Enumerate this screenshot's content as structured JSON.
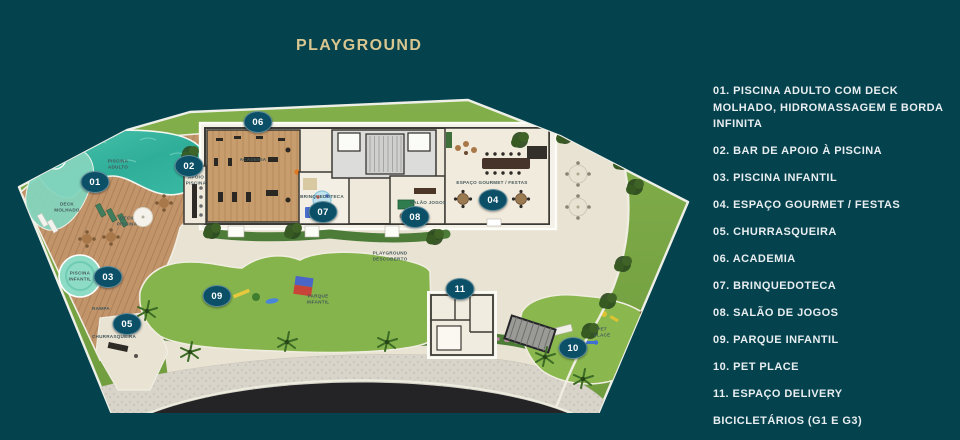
{
  "title": {
    "text": "PLAYGROUND"
  },
  "colors": {
    "background": "#04424e",
    "title": "#d8c690",
    "badge": "#0c5068",
    "legendtext": "#e8eef0",
    "labelink": "#44585a",
    "grass": "#7ca946",
    "patio": "#e9e3d3",
    "pool": "#35b3a0",
    "deck": "#c2946a"
  },
  "legend": {
    "items": [
      {
        "number": "01.",
        "text": "PISCINA ADULTO COM DECK MOLHADO, HIDROMASSAGEM E BORDA INFINITA"
      },
      {
        "number": "02.",
        "text": "BAR DE APOIO À PISCINA"
      },
      {
        "number": "03.",
        "text": "PISCINA INFANTIL"
      },
      {
        "number": "04.",
        "text": "ESPAÇO GOURMET / FESTAS"
      },
      {
        "number": "05.",
        "text": "CHURRASQUEIRA"
      },
      {
        "number": "06.",
        "text": "ACADEMIA"
      },
      {
        "number": "07.",
        "text": "BRINQUEDOTECA"
      },
      {
        "number": "08.",
        "text": "SALÃO DE JOGOS"
      },
      {
        "number": "09.",
        "text": "PARQUE INFANTIL"
      },
      {
        "number": "10.",
        "text": "PET PLACE"
      },
      {
        "number": "11.",
        "text": "ESPAÇO DELIVERY"
      },
      {
        "number": "",
        "text": "BICICLETÁRIOS (G1 E G3)"
      }
    ]
  },
  "plan": {
    "markers": [
      {
        "id": "01",
        "x": 95,
        "y": 182
      },
      {
        "id": "02",
        "x": 189,
        "y": 166
      },
      {
        "id": "03",
        "x": 108,
        "y": 277
      },
      {
        "id": "04",
        "x": 493,
        "y": 200
      },
      {
        "id": "05",
        "x": 127,
        "y": 324
      },
      {
        "id": "06",
        "x": 258,
        "y": 122
      },
      {
        "id": "07",
        "x": 323,
        "y": 212
      },
      {
        "id": "08",
        "x": 415,
        "y": 217
      },
      {
        "id": "09",
        "x": 217,
        "y": 296
      },
      {
        "id": "10",
        "x": 573,
        "y": 348
      },
      {
        "id": "11",
        "x": 460,
        "y": 289
      }
    ],
    "labels": [
      {
        "text": "PISCINA\nADULTO",
        "x": 118,
        "y": 164
      },
      {
        "text": "DECK\nMOLHADO",
        "x": 67,
        "y": 207
      },
      {
        "text": "DECK\nPISCINA",
        "x": 127,
        "y": 221
      },
      {
        "text": "PISCINA\nINFANTIL",
        "x": 80,
        "y": 276
      },
      {
        "text": "RAMPA",
        "x": 101,
        "y": 309
      },
      {
        "text": "CHURRASQUEIRA",
        "x": 114,
        "y": 337
      },
      {
        "text": "APOIO\nPISCINA",
        "x": 196,
        "y": 180
      },
      {
        "text": "ACADEMIA",
        "x": 253,
        "y": 160
      },
      {
        "text": "BRINQUEDOTECA",
        "x": 322,
        "y": 197
      },
      {
        "text": "SALÃO JOGOS",
        "x": 428,
        "y": 203
      },
      {
        "text": "ESPAÇO GOURMET / FESTAS",
        "x": 492,
        "y": 183
      },
      {
        "text": "PLAYGROUND\nDESCOBERTO",
        "x": 390,
        "y": 256
      },
      {
        "text": "PARQUE\nINFANTIL",
        "x": 318,
        "y": 299
      },
      {
        "text": "PET\nPLACE",
        "x": 602,
        "y": 332
      }
    ]
  }
}
